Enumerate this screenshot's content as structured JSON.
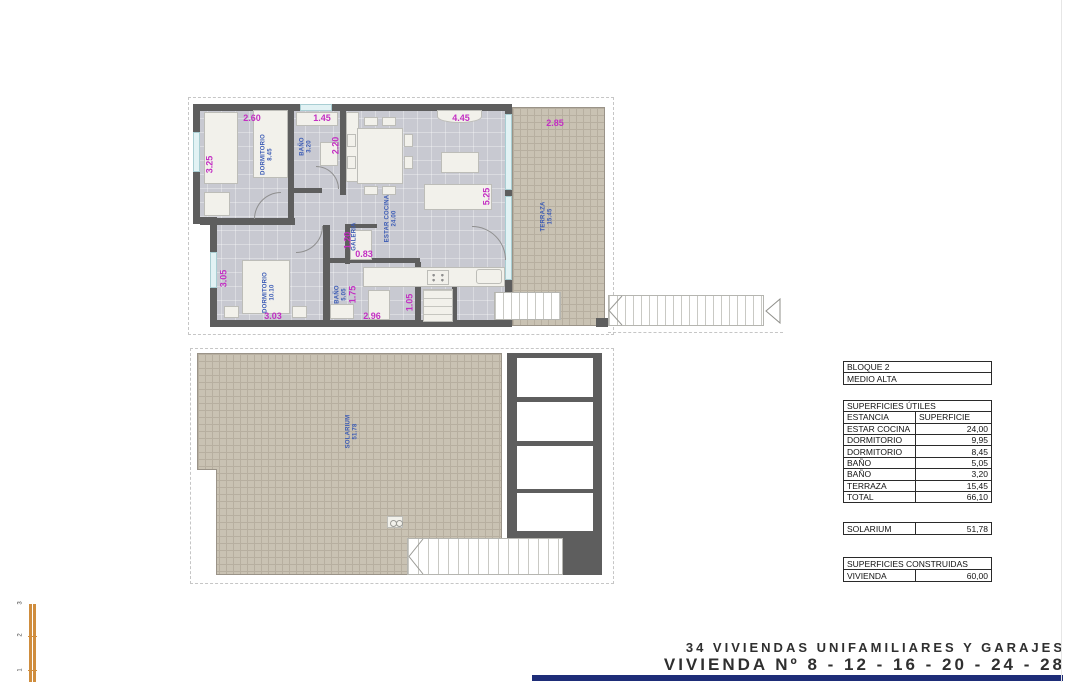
{
  "colors": {
    "wall": "#5e5e5e",
    "floor": "#c8c9d1",
    "hatch_fill": "#c9c2b3",
    "dimension_text": "#c32fc3",
    "room_label_text": "#3b5bb5",
    "navy_bar": "#1e2d78",
    "scale_bar": "#cf8d3e"
  },
  "plan_upper": {
    "dims": {
      "w_dorm1": "2.60",
      "w_bath1": "1.45",
      "w_estar": "4.45",
      "w_terraza": "2.85",
      "h_dorm1": "3.25",
      "h_closet_top": "2.20",
      "h_estar": "5.25",
      "h_dorm2": "3.05",
      "h_galeria": "1.20",
      "w_galeria": "0.83",
      "h_bath2": "1.75",
      "w_dorm2": "3.03",
      "w_bath2": "2.96",
      "w_closet": "1.05"
    },
    "rooms": {
      "dorm1_name": "DORMITORIO",
      "dorm1_area": "8.45",
      "bath1_name": "BAÑO",
      "bath1_area": "3.20",
      "estar_name": "ESTAR COCINA",
      "estar_area": "24.00",
      "galeria_name": "GALERIA",
      "dorm2_name": "DORMITORIO",
      "dorm2_area": "10.10",
      "bath2_name": "BAÑO",
      "bath2_area": "5.05",
      "terraza_name": "TERRAZA",
      "terraza_area": "15.45"
    }
  },
  "plan_lower": {
    "solarium_name": "SOLARIUM",
    "solarium_area": "51.78"
  },
  "table": {
    "header1": "BLOQUE 2",
    "header2": "MEDIO ALTA",
    "section1": "SUPERFICIES ÚTILES",
    "col_left": "ESTANCIA",
    "col_right": "SUPERFICIE",
    "rows": [
      {
        "label": "ESTAR COCINA",
        "value": "24,00"
      },
      {
        "label": "DORMITORIO",
        "value": "9,95"
      },
      {
        "label": "DORMITORIO",
        "value": "8,45"
      },
      {
        "label": "BAÑO",
        "value": "5,05"
      },
      {
        "label": "BAÑO",
        "value": "3,20"
      },
      {
        "label": "TERRAZA",
        "value": "15,45"
      },
      {
        "label": "TOTAL",
        "value": "66,10"
      }
    ],
    "solarium_label": "SOLARIUM",
    "solarium_value": "51,78",
    "section2": "SUPERFICIES CONSTRUIDAS",
    "vivienda_label": "VIVIENDA",
    "vivienda_value": "60,00"
  },
  "title": {
    "line1": "34 VIVIENDAS UNIFAMILIARES Y GARAJES",
    "line2": "VIVIENDA Nº 8 - 12 - 16 - 20 - 24 - 28"
  },
  "scale_bar": {
    "t3": "3",
    "t2": "2",
    "t1": "1"
  }
}
